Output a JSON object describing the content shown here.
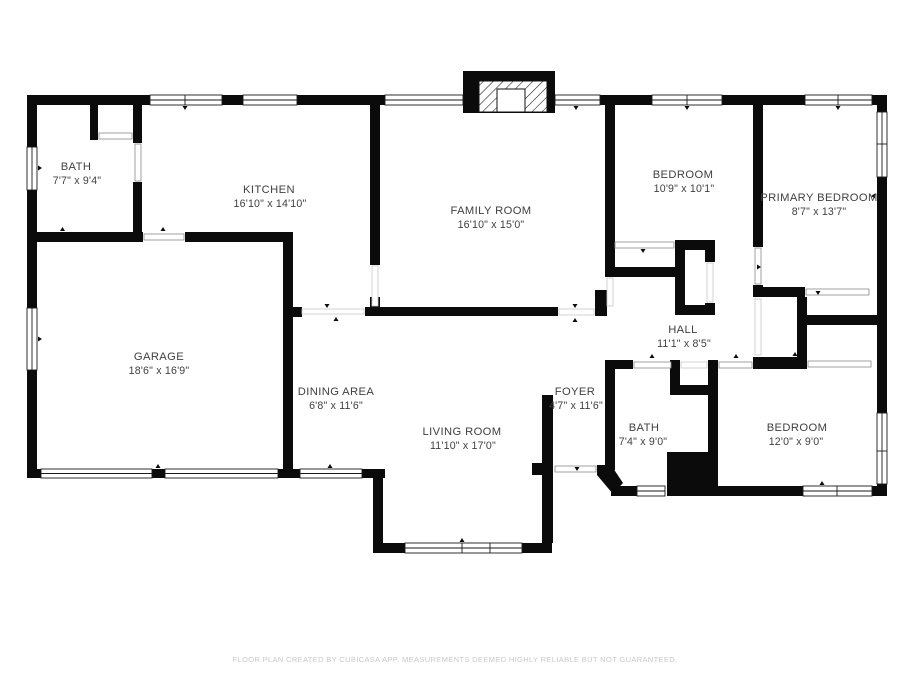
{
  "plan": {
    "colors": {
      "wall": "#0b0b0b",
      "label": "#3f3f3f",
      "footer": "#c9c9c9",
      "background": "#ffffff"
    },
    "rooms": [
      {
        "name": "BATH",
        "dims": "7'7\" x 9'4\""
      },
      {
        "name": "KITCHEN",
        "dims": "16'10\" x 14'10\""
      },
      {
        "name": "FAMILY ROOM",
        "dims": "16'10\" x 15'0\""
      },
      {
        "name": "BEDROOM",
        "dims": "10'9\" x 10'1\""
      },
      {
        "name": "PRIMARY BEDROOM",
        "dims": "8'7\" x 13'7\""
      },
      {
        "name": "GARAGE",
        "dims": "18'6\" x 16'9\""
      },
      {
        "name": "DINING AREA",
        "dims": "6'8\" x 11'6\""
      },
      {
        "name": "LIVING ROOM",
        "dims": "11'10\" x 17'0\""
      },
      {
        "name": "FOYER",
        "dims": "4'7\" x 11'6\""
      },
      {
        "name": "HALL",
        "dims": "11'1\" x 8'5\""
      },
      {
        "name": "BATH",
        "dims": "7'4\" x 9'0\""
      },
      {
        "name": "BEDROOM",
        "dims": "12'0\" x 9'0\""
      }
    ],
    "features": [
      {
        "name": "fireplace"
      },
      {
        "name": "utility-chase"
      }
    ],
    "footer": "FLOOR PLAN CREATED BY CUBICASA APP. MEASUREMENTS DEEMED HIGHLY RELIABLE BUT NOT GUARANTEED."
  }
}
